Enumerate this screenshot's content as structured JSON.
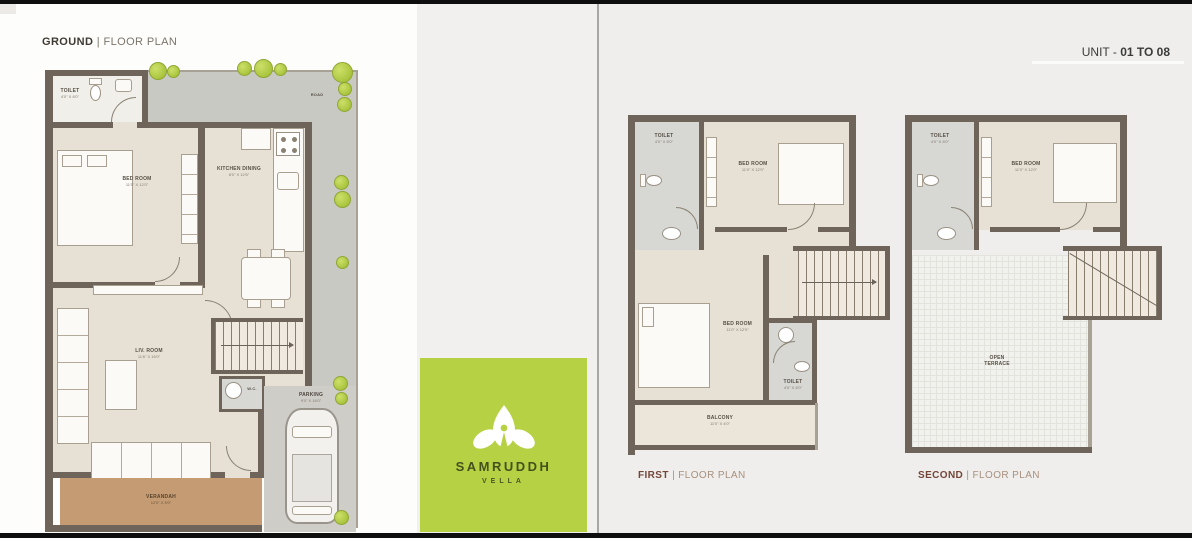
{
  "header": {
    "unit_prefix": "UNIT - ",
    "unit_range": "01 TO 08"
  },
  "brand": {
    "name": "SAMRUDDH",
    "tagline": "VELLA"
  },
  "ground_plan": {
    "title_bold": "GROUND",
    "title_rest": "| FLOOR PLAN",
    "labels": {
      "toilet": "TOILET",
      "toilet_dim": "4'0\" X 6'0\"",
      "bedroom": "BED ROOM",
      "bedroom_dim": "11'0\" X 12'0\"",
      "kitchen": "KITCHEN DINING",
      "kitchen_dim": "8'0\" X 12'6\"",
      "living": "LIV. ROOM",
      "living_dim": "11'6\" X 16'0\"",
      "wc": "W.C.",
      "parking": "PARKING",
      "parking_dim": "9'0\" X 16'0\"",
      "verandah": "VERANDAH",
      "verandah_dim": "12'0\" X 5'0\"",
      "road": "ROAD"
    }
  },
  "first_plan": {
    "title_bold": "FIRST",
    "title_rest": "| FLOOR PLAN",
    "labels": {
      "toilet_top": "TOILET",
      "toilet_top_dim": "4'0\" X 6'0\"",
      "bedroom_top": "BED ROOM",
      "bedroom_top_dim": "11'0\" X 12'0\"",
      "bedroom_mid": "BED ROOM",
      "bedroom_mid_dim": "11'0\" X 12'0\"",
      "toilet_mid": "TOILET",
      "toilet_mid_dim": "4'0\" X 6'0\"",
      "balcony": "BALCONY",
      "balcony_dim": "11'0\" X 4'0\""
    }
  },
  "second_plan": {
    "title_bold": "SECOND",
    "title_rest": "| FLOOR PLAN",
    "labels": {
      "toilet": "TOILET",
      "toilet_dim": "4'0\" X 6'0\"",
      "bedroom": "BED ROOM",
      "bedroom_dim": "11'0\" X 12'0\"",
      "terrace_line1": "OPEN",
      "terrace_line2": "TERRACE"
    }
  },
  "colors": {
    "accent_green": "#b6d244",
    "wall": "#6f6459",
    "floor_beige": "#e7e1d5",
    "outdoor_gray": "#c9c9c4",
    "verandah_tan": "#c49b72"
  }
}
